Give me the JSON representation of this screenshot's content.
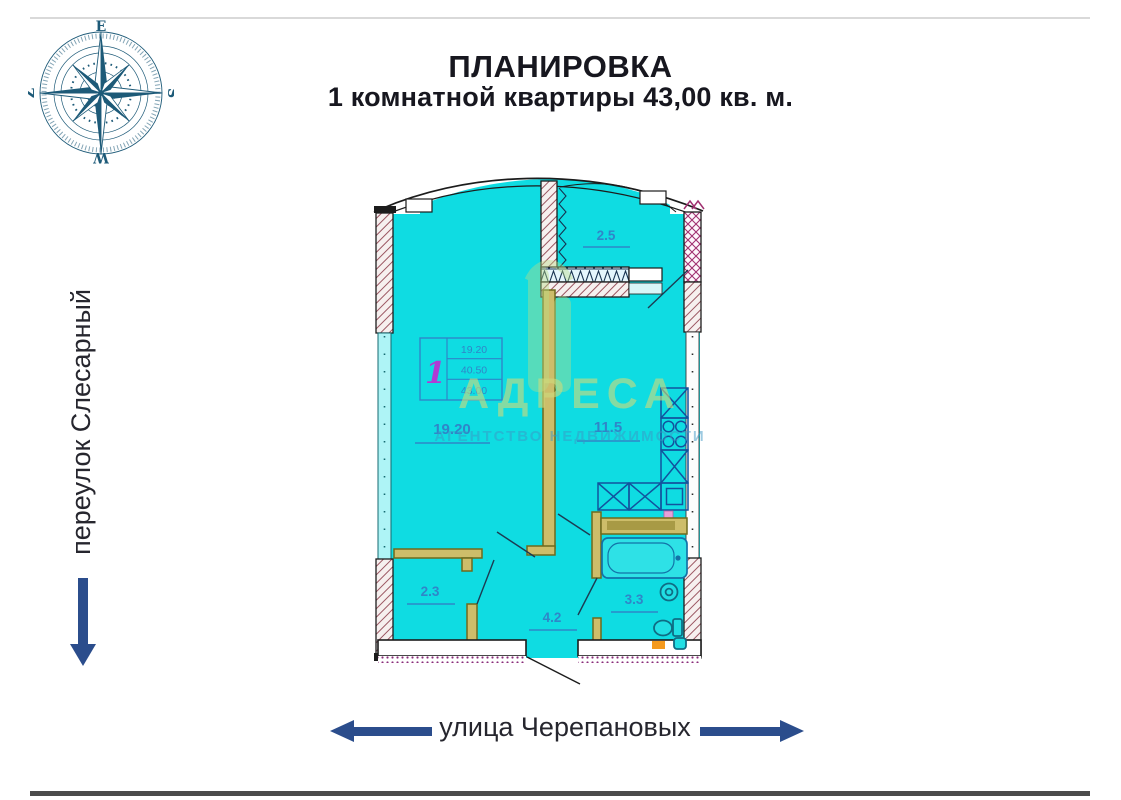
{
  "header": {
    "title_line1": "ПЛАНИРОВКА",
    "title_line2": "1 комнатной квартиры 43,00 кв. м."
  },
  "compass": {
    "top": "E",
    "right": "S",
    "bottom": "W",
    "left": "Z"
  },
  "streets": {
    "left": {
      "name": "переулок Слесарный",
      "direction": "down-arrow"
    },
    "bottom": {
      "name": "улица Черепановых",
      "direction": "left-right-arrows"
    }
  },
  "floorplan": {
    "rooms": [
      {
        "id": "living-room",
        "area": "19.20"
      },
      {
        "id": "kitchen",
        "area": "11.5"
      },
      {
        "id": "balcony",
        "area": "2.5"
      },
      {
        "id": "closet",
        "area": "2.3"
      },
      {
        "id": "hallway",
        "area": "4.2"
      },
      {
        "id": "bathroom",
        "area": "3.3"
      }
    ],
    "stamp": {
      "rooms_count": "1",
      "living_area": "19.20",
      "apartment_area": "40.50",
      "total_area": "43.00"
    },
    "watermark": {
      "title": "АДРЕСА",
      "subtitle": "АГЕНТСТВО НЕДВИЖИМОСТИ"
    }
  },
  "colors": {
    "floor_fill": "#0fdce2",
    "label_blue": "#2f86c8",
    "partition_olive": "#cdbd6a",
    "arrow_blue": "#2b4d8c",
    "wall_hatch": "#9a5560",
    "crosshatch_magenta": "#a03070",
    "stamp_number_magenta": "#b13bd4",
    "compass_teal": "#1d5a78",
    "accent_orange": "#f59a1e"
  }
}
